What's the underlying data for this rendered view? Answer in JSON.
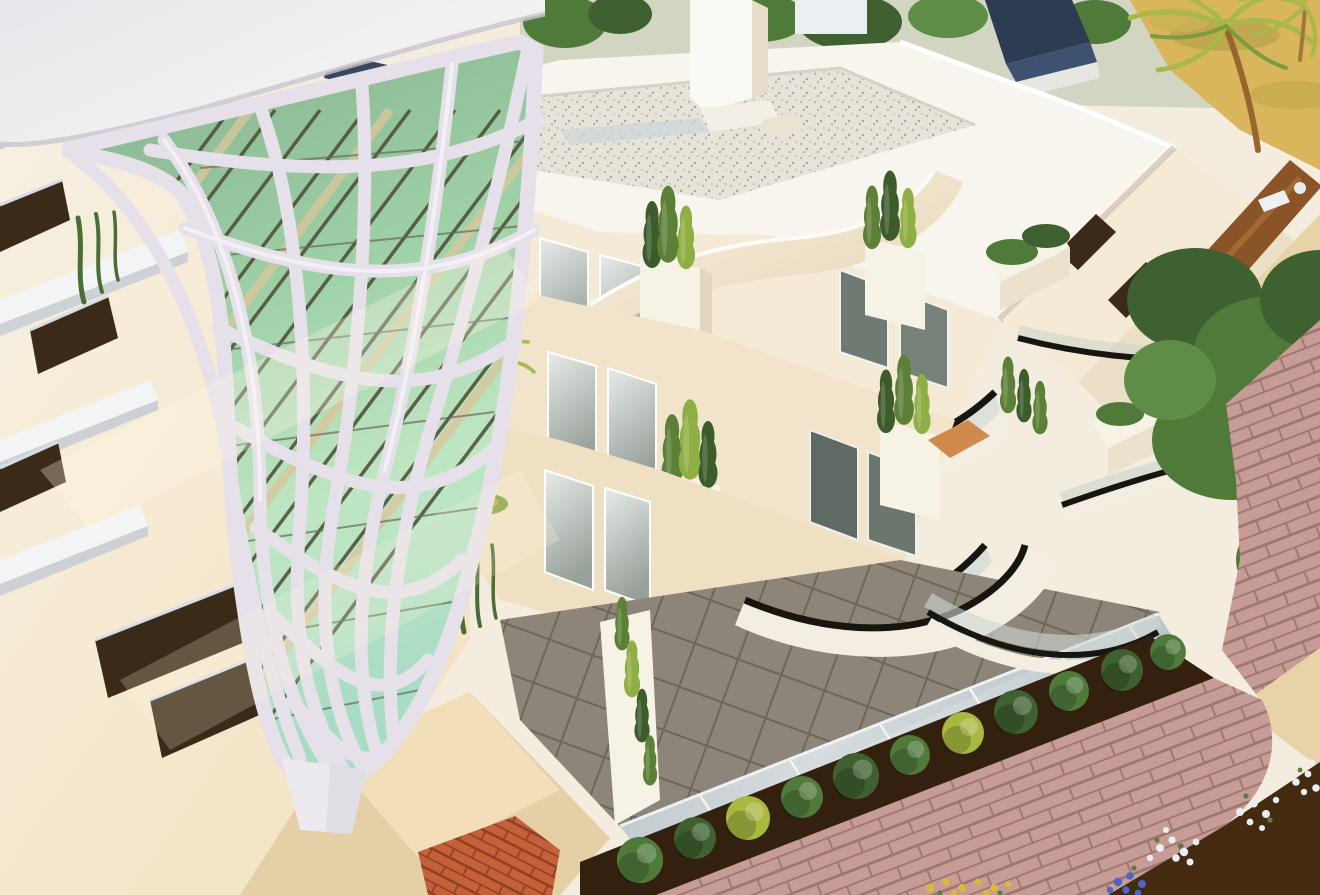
{
  "image": {
    "kind": "3d-architectural-render",
    "alt": "Aerial 3D rendering of a modern white apartment building with an organic lattice facade tower over green glass, stacked curved glass balconies with black handrails, planters with cypress shrubs and hanging vines, a gravel rooftop terrace, and landscaped grounds with a hedge row, pink paver walkways, sand paths, palm trees and flower beds."
  },
  "objects": [
    "lattice-tower",
    "rooftop-terrace",
    "chimney",
    "curved-balconies",
    "glass-balustrades",
    "terrace-tiles",
    "planter-boxes",
    "cypress-shrubs",
    "hanging-vines",
    "palm-trees",
    "garden-trees",
    "hedge-row",
    "pink-paver-walkway",
    "sand-path",
    "dirt-path",
    "flower-beds",
    "distant-houses",
    "left-facade-windows"
  ],
  "palette": {
    "page_bg": "#f3ecdf",
    "haze": "#cdd3bf",
    "sand_yellow": "#d9b65c",
    "roof_navy": "#2c3c52",
    "roof_navy_light": "#3d5270",
    "distant_white": "#eceff1",
    "tree_dark": "#3f6030",
    "tree_mid": "#4f7a3a",
    "tree_light": "#5f8c46",
    "trunk_brown": "#96662e",
    "palm_green": "#a9b84a",
    "palm_green_dark": "#7d9b3f",
    "dirt_brown": "#8a5426",
    "path_tan": "#e8d3a8",
    "roof_white": "#f8f5ef",
    "gravel_base": "#e6e3da",
    "gravel_dot": "#b9b5aa",
    "chimney_white": "#fbf9f4",
    "chimney_shade": "#e7ddcb",
    "wall_sun": "#f5ead6",
    "wall_warm": "#f2e4cb",
    "wall_deep": "#efe0c4",
    "facade_hi": "#f7f1e4",
    "facade_lo": "#f4e3c2",
    "window_dark": "#3a2a17",
    "window_navy": "#2e3e54",
    "win_hi": "#e8ece9",
    "win_lo": "#97a099",
    "rail_dark": "#17150f",
    "glass_fence_hi": "#dde4e8",
    "glass_fence_lo": "#aebec7",
    "tile_light": "#bdb3a7",
    "tile_mid": "#a69c90",
    "tile_dark": "#8e857a",
    "grout": "#7b7369",
    "fascia_white": "#f3eee1",
    "planter_white": "#f7f2e6",
    "planter_gold": "#d8a43e",
    "clay_orange": "#d08a4e",
    "soil_dark": "#33200e",
    "soil_deep": "#452a12",
    "paver_pink": "#c79b96",
    "paver_line": "#9f7570",
    "brick_orange": "#c4603a",
    "brick_line": "#8e3f22",
    "flower_white": "#e9eef4",
    "flower_blue": "#4a66c8",
    "flower_yellow": "#d9b93a",
    "flower_orange": "#dfa02f",
    "flower_leaf": "#5c7c3c",
    "vine_green": "#4a6e33",
    "cypress_dark": "#3d5c2c",
    "cypress_mid": "#5c8038",
    "cypress_light": "#8fae43",
    "lattice_white": "#e6e0ea",
    "lattice_hi": "#f6f3f7",
    "glass_top": "#84b08e",
    "glass_mid": "#9ed0a6",
    "glass_low": "#bfe6c3",
    "glass_mint": "#a8dcc4",
    "mullion": "#4c4a36",
    "beam_cream": "#d8c79c",
    "cap_hi": "#f7f5f2",
    "cap_lo": "#e8e7ec",
    "drum_hi": "#f7f0e1",
    "drum_lo": "#e7d5b5",
    "slab_white": "#f2f4f6",
    "shadow_cool": "#c3ccd8"
  }
}
